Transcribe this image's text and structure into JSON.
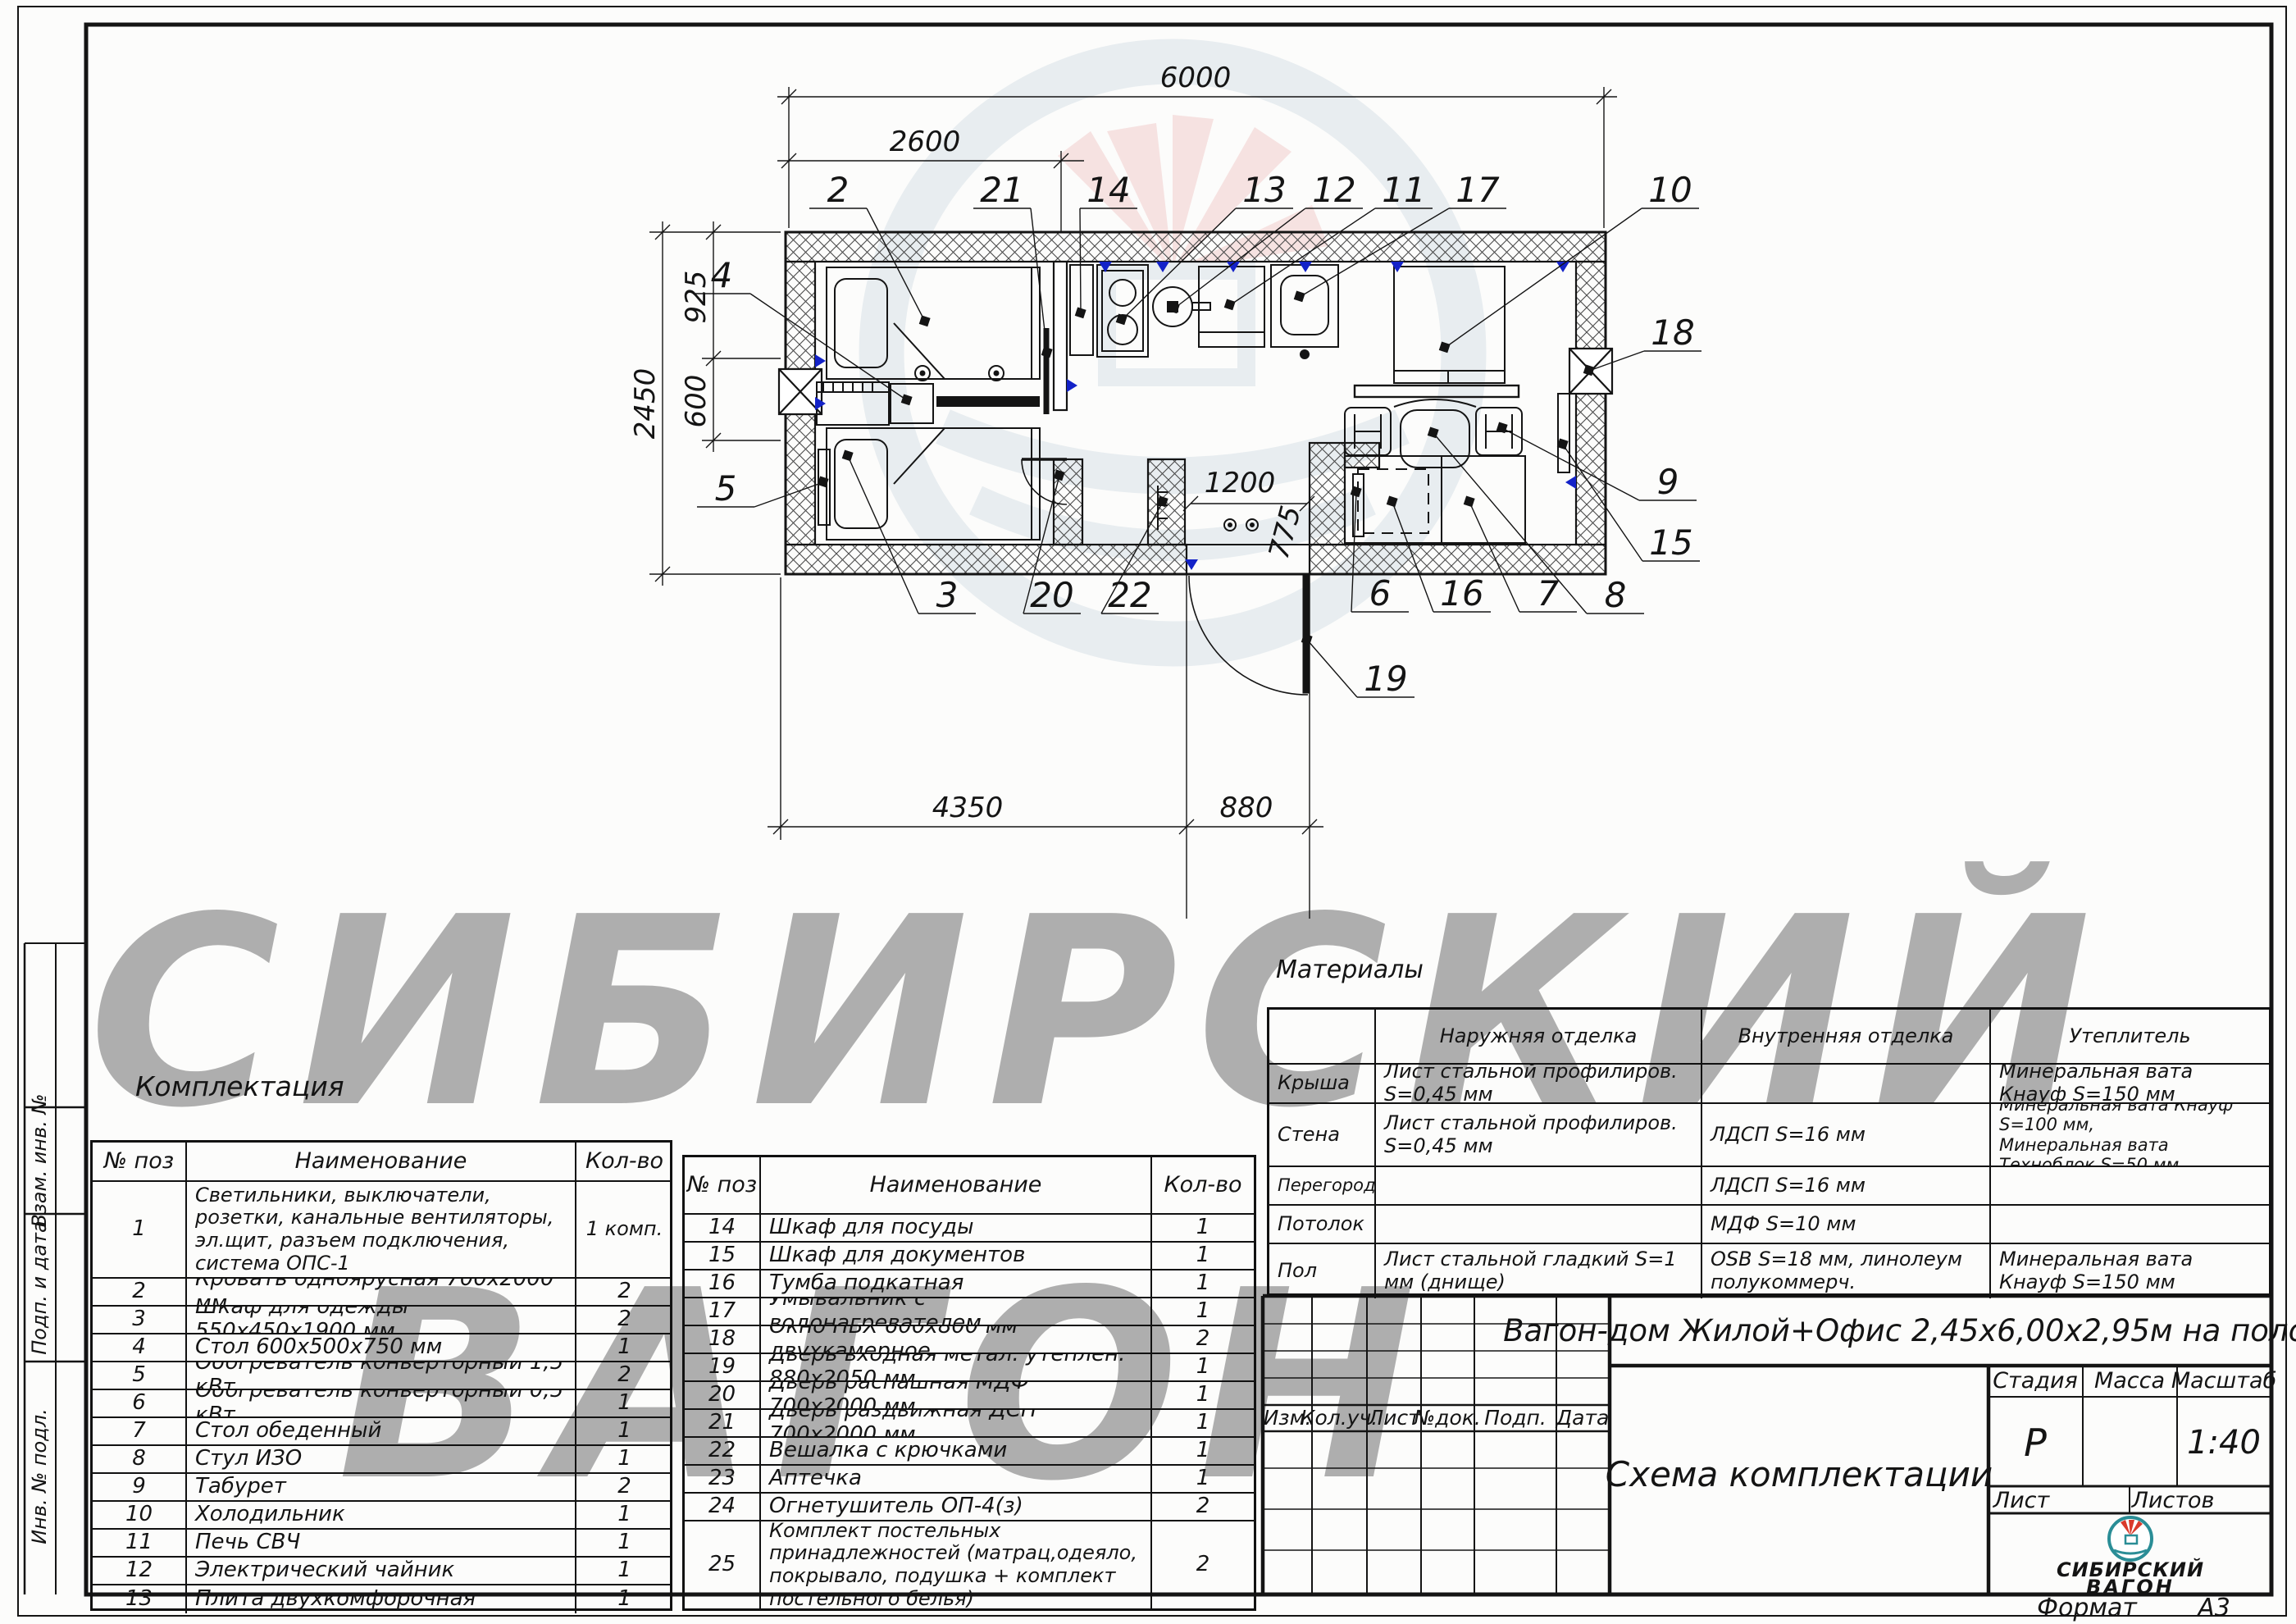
{
  "titles": {
    "komplektacia": "Комплектация",
    "materialy": "Материалы"
  },
  "watermark": {
    "line1": "СИБИРСКИЙ",
    "line2": "ВАГОН"
  },
  "plan": {
    "dims": {
      "d6000": "6000",
      "d2600": "2600",
      "d2450": "2450",
      "d925": "925",
      "d600": "600",
      "d4350": "4350",
      "d880": "880",
      "d1200": "1200",
      "d775": "775"
    },
    "callouts": [
      "2",
      "21",
      "14",
      "13",
      "12",
      "11",
      "17",
      "10",
      "4",
      "5",
      "18",
      "9",
      "15",
      "8",
      "3",
      "20",
      "22",
      "6",
      "16",
      "7",
      "19"
    ]
  },
  "equip1": {
    "headers": {
      "pos": "№ поз",
      "name": "Наименование",
      "qty": "Кол-во"
    },
    "rows": [
      {
        "pos": "1",
        "name": "Светильники, выключатели, розетки, канальные вентиляторы, эл.щит, разъем подключения, система ОПС-1",
        "qty": "1 комп."
      },
      {
        "pos": "2",
        "name": "Кровать одноярусная 700х2000 мм",
        "qty": "2"
      },
      {
        "pos": "3",
        "name": "Шкаф для одежды 550х450х1900 мм",
        "qty": "2"
      },
      {
        "pos": "4",
        "name": "Стол 600х500х750 мм",
        "qty": "1"
      },
      {
        "pos": "5",
        "name": "Обогреватель конверторный 1,5 кВт",
        "qty": "2"
      },
      {
        "pos": "6",
        "name": "Обогреватель конверторный 0,5 кВт",
        "qty": "1"
      },
      {
        "pos": "7",
        "name": "Стол обеденный",
        "qty": "1"
      },
      {
        "pos": "8",
        "name": "Стул ИЗО",
        "qty": "1"
      },
      {
        "pos": "9",
        "name": "Табурет",
        "qty": "2"
      },
      {
        "pos": "10",
        "name": "Холодильник",
        "qty": "1"
      },
      {
        "pos": "11",
        "name": "Печь СВЧ",
        "qty": "1"
      },
      {
        "pos": "12",
        "name": "Электрический чайник",
        "qty": "1"
      },
      {
        "pos": "13",
        "name": "Плита двухкомфорочная",
        "qty": "1"
      }
    ]
  },
  "equip2": {
    "headers": {
      "pos": "№ поз",
      "name": "Наименование",
      "qty": "Кол-во"
    },
    "rows": [
      {
        "pos": "14",
        "name": "Шкаф для посуды",
        "qty": "1"
      },
      {
        "pos": "15",
        "name": "Шкаф для документов",
        "qty": "1"
      },
      {
        "pos": "16",
        "name": "Тумба подкатная",
        "qty": "1"
      },
      {
        "pos": "17",
        "name": "Умывальник с водонагревателем",
        "qty": "1"
      },
      {
        "pos": "18",
        "name": "Окно ПВХ 600х800 мм двухкамерное",
        "qty": "2"
      },
      {
        "pos": "19",
        "name": "Дверь входная метал. утеплен. 880х2050 мм",
        "qty": "1"
      },
      {
        "pos": "20",
        "name": "Дверь распашная МДФ 700х2000 мм",
        "qty": "1"
      },
      {
        "pos": "21",
        "name": "Дверь раздвижная ДСП 700х2000 мм",
        "qty": "1"
      },
      {
        "pos": "22",
        "name": "Вешалка с крючками",
        "qty": "1"
      },
      {
        "pos": "23",
        "name": "Аптечка",
        "qty": "1"
      },
      {
        "pos": "24",
        "name": "Огнетушитель ОП-4(з)",
        "qty": "2"
      },
      {
        "pos": "25",
        "name": "Комплект постельных принадлежностей (матрац,одеяло, покрывало, подушка + комплект постельного белья)",
        "qty": "2"
      }
    ]
  },
  "materials": {
    "headers": {
      "outer": "Наружняя отделка",
      "inner": "Внутренняя отделка",
      "ins": "Утеплитель"
    },
    "rows": [
      {
        "label": "Крыша",
        "outer": "Лист стальной профилиров. S=0,45 мм",
        "inner": "",
        "ins": "Минеральная вата Кнауф S=150 мм"
      },
      {
        "label": "Стена",
        "outer": "Лист стальной профилиров. S=0,45 мм",
        "inner": "ЛДСП S=16 мм",
        "ins": "Минеральная вата Кнауф S=100 мм,\nМинеральная вата Техноблок S=50 мм"
      },
      {
        "label": "Перегородка",
        "outer": "",
        "inner": "ЛДСП S=16 мм",
        "ins": ""
      },
      {
        "label": "Потолок",
        "outer": "",
        "inner": "МДФ S=10 мм",
        "ins": ""
      },
      {
        "label": "Пол",
        "outer": "Лист стальной гладкий S=1 мм (днище)",
        "inner": "OSB S=18 мм,  линолеум\nполукоммерч.",
        "ins": "Минеральная вата Кнауф S=150 мм"
      }
    ]
  },
  "stamp": {
    "cols": [
      "Изм.",
      "Кол.уч.",
      "Лист",
      "№док.",
      "Подп.",
      "Дата"
    ],
    "doc_title": "Вагон-дом Жилой+Офис 2,45х6,00х2,95м на полозьях",
    "sheet_title": "Схема комплектации",
    "stage_label": "Стадия",
    "mass_label": "Масса",
    "scale_label": "Масштаб",
    "stage": "Р",
    "scale": "1:40",
    "list_label": "Лист",
    "listov_label": "Листов",
    "format_label": "Формат",
    "format": "А3",
    "logo_line1": "СИБИРСКИЙ",
    "logo_line2": "ВАГОН",
    "logo_color": "#2a8d96",
    "logo_red": "#d93a2b"
  },
  "side": {
    "labels": [
      "Взам. инв. №",
      "Подп. и дата",
      "Инв. № подл."
    ]
  }
}
